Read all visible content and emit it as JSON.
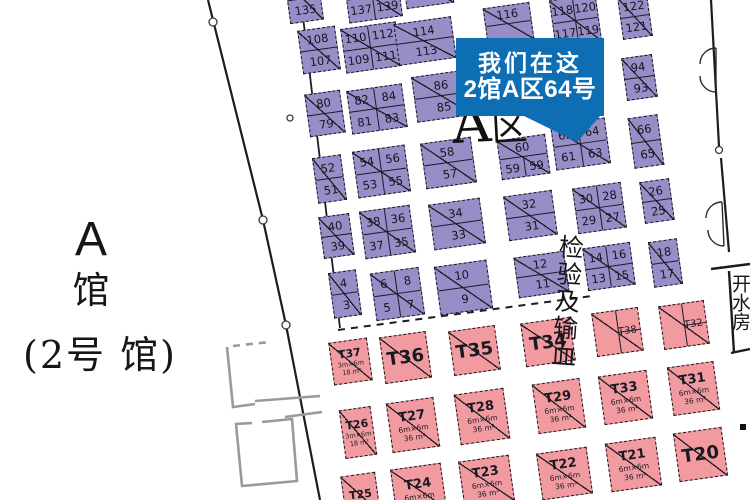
{
  "hall_label": {
    "letter": "A",
    "hall_char": "馆",
    "sub": "(2号 馆)"
  },
  "zone_label": {
    "a": "A",
    "qu": "区"
  },
  "callout": {
    "line1": "我们在这",
    "line2": "2馆A区64号",
    "color": "#0e6eb4"
  },
  "inspection_label": "检验及输血",
  "water_room_label": "开水房",
  "colors": {
    "booth_purple": "#968fc7",
    "booth_pink": "#f19ba1",
    "callout_blue": "#0e6eb4",
    "wall": "#1c1c24"
  },
  "purple_booths": [
    {
      "id": "135",
      "x": 287,
      "y": -24,
      "w": 34,
      "h": 46,
      "cols": 1,
      "cells": [
        {
          "t": "",
          "bd": "b"
        },
        {
          "t": "135"
        }
      ]
    },
    {
      "id": "137-139",
      "x": 346,
      "y": -26,
      "w": 54,
      "h": 46,
      "cols": 2,
      "cells": [
        {
          "t": "",
          "bd": "rb"
        },
        {
          "t": "",
          "bd": "b"
        },
        {
          "t": "137",
          "bd": "r"
        },
        {
          "t": "139"
        }
      ]
    },
    {
      "id": "top-sliver",
      "x": 404,
      "y": -30,
      "w": 48,
      "h": 36,
      "cols": 1,
      "cells": [
        {
          "t": "",
          "bd": "b"
        },
        {
          "t": ""
        }
      ]
    },
    {
      "id": "108-107",
      "x": 300,
      "y": 28,
      "w": 38,
      "h": 44,
      "cols": 1,
      "cells": [
        {
          "t": "108",
          "bd": "b"
        },
        {
          "t": "107"
        }
      ]
    },
    {
      "id": "110-112-109-111",
      "x": 343,
      "y": 25,
      "w": 56,
      "h": 45,
      "cols": 2,
      "cells": [
        {
          "t": "110",
          "bd": "rb"
        },
        {
          "t": "112",
          "bd": "b"
        },
        {
          "t": "109",
          "bd": "r"
        },
        {
          "t": "111"
        }
      ]
    },
    {
      "id": "114-113",
      "x": 396,
      "y": 20,
      "w": 58,
      "h": 42,
      "cols": 1,
      "cells": [
        {
          "t": "114",
          "bd": "b"
        },
        {
          "t": "113"
        }
      ]
    },
    {
      "id": "116",
      "x": 485,
      "y": 5,
      "w": 47,
      "h": 37,
      "cols": 1,
      "cells": [
        {
          "t": "116",
          "bd": "b"
        },
        {
          "t": ""
        }
      ]
    },
    {
      "id": "118-120-117-119",
      "x": 552,
      "y": -3,
      "w": 47,
      "h": 47,
      "cols": 2,
      "cells": [
        {
          "t": "118",
          "bd": "rb"
        },
        {
          "t": "120",
          "bd": "b"
        },
        {
          "t": "117",
          "bd": "r"
        },
        {
          "t": "119"
        }
      ]
    },
    {
      "id": "122-121",
      "x": 620,
      "y": -5,
      "w": 30,
      "h": 43,
      "cols": 1,
      "cells": [
        {
          "t": "122",
          "bd": "b"
        },
        {
          "t": "121"
        }
      ]
    },
    {
      "id": "94-93",
      "x": 624,
      "y": 56,
      "w": 31,
      "h": 43,
      "cols": 1,
      "cells": [
        {
          "t": "94",
          "bd": "b"
        },
        {
          "t": "93"
        }
      ]
    },
    {
      "id": "80-79",
      "x": 307,
      "y": 92,
      "w": 36,
      "h": 43,
      "cols": 1,
      "cells": [
        {
          "t": "80",
          "bd": "b"
        },
        {
          "t": "79"
        }
      ]
    },
    {
      "id": "82-84-81-83",
      "x": 349,
      "y": 87,
      "w": 56,
      "h": 44,
      "cols": 2,
      "cells": [
        {
          "t": "82",
          "bd": "rb"
        },
        {
          "t": "84",
          "bd": "b"
        },
        {
          "t": "81",
          "bd": "r"
        },
        {
          "t": "83"
        }
      ]
    },
    {
      "id": "86-85",
      "x": 414,
      "y": 73,
      "w": 57,
      "h": 46,
      "cols": 1,
      "cells": [
        {
          "t": "86",
          "bd": "b"
        },
        {
          "t": "85"
        }
      ]
    },
    {
      "id": "60-59",
      "x": 499,
      "y": 137,
      "w": 49,
      "h": 40,
      "cols": 2,
      "cells": [
        {
          "t": "60",
          "bd": "b",
          "span": 2
        },
        {
          "t": "59",
          "bd": "r"
        },
        {
          "t": "59"
        }
      ]
    },
    {
      "id": "62-64-61-63",
      "x": 553,
      "y": 121,
      "w": 55,
      "h": 46,
      "cols": 2,
      "cells": [
        {
          "t": "62",
          "bd": "rb"
        },
        {
          "t": "64",
          "bd": "b"
        },
        {
          "t": "61",
          "bd": "r"
        },
        {
          "t": "63"
        }
      ]
    },
    {
      "id": "66-65",
      "x": 631,
      "y": 116,
      "w": 30,
      "h": 51,
      "cols": 1,
      "cells": [
        {
          "t": "66",
          "bd": "b"
        },
        {
          "t": "65"
        }
      ]
    },
    {
      "id": "58-57",
      "x": 423,
      "y": 140,
      "w": 51,
      "h": 46,
      "cols": 1,
      "cells": [
        {
          "t": "58",
          "bd": "b"
        },
        {
          "t": "57"
        }
      ]
    },
    {
      "id": "54-56-53-55",
      "x": 355,
      "y": 148,
      "w": 53,
      "h": 47,
      "cols": 2,
      "cells": [
        {
          "t": "54",
          "bd": "rb"
        },
        {
          "t": "56",
          "bd": "b"
        },
        {
          "t": "53",
          "bd": "r"
        },
        {
          "t": "55"
        }
      ]
    },
    {
      "id": "52-51",
      "x": 315,
      "y": 156,
      "w": 29,
      "h": 46,
      "cols": 1,
      "cells": [
        {
          "t": "52",
          "bd": "b"
        },
        {
          "t": "51"
        }
      ]
    },
    {
      "id": "32-31",
      "x": 506,
      "y": 193,
      "w": 49,
      "h": 45,
      "cols": 1,
      "cells": [
        {
          "t": "32",
          "bd": "b"
        },
        {
          "t": "31"
        }
      ]
    },
    {
      "id": "30-28-29-27",
      "x": 575,
      "y": 185,
      "w": 49,
      "h": 46,
      "cols": 2,
      "cells": [
        {
          "t": "30",
          "bd": "rb"
        },
        {
          "t": "28",
          "bd": "b"
        },
        {
          "t": "29",
          "bd": "r"
        },
        {
          "t": "27"
        }
      ]
    },
    {
      "id": "26-25",
      "x": 642,
      "y": 180,
      "w": 30,
      "h": 42,
      "cols": 1,
      "cells": [
        {
          "t": "26",
          "bd": "b"
        },
        {
          "t": "25"
        }
      ]
    },
    {
      "id": "34-33",
      "x": 431,
      "y": 201,
      "w": 52,
      "h": 46,
      "cols": 1,
      "cells": [
        {
          "t": "34",
          "bd": "b"
        },
        {
          "t": "33"
        }
      ]
    },
    {
      "id": "38-36-37-35",
      "x": 362,
      "y": 208,
      "w": 51,
      "h": 48,
      "cols": 2,
      "cells": [
        {
          "t": "38",
          "bd": "rb"
        },
        {
          "t": "36",
          "bd": "b"
        },
        {
          "t": "37",
          "bd": "r"
        },
        {
          "t": "35"
        }
      ]
    },
    {
      "id": "40-39",
      "x": 321,
      "y": 215,
      "w": 31,
      "h": 42,
      "cols": 1,
      "cells": [
        {
          "t": "40",
          "bd": "b"
        },
        {
          "t": "39"
        }
      ]
    },
    {
      "id": "12-11",
      "x": 516,
      "y": 254,
      "w": 51,
      "h": 41,
      "cols": 1,
      "cells": [
        {
          "t": "12",
          "bd": "b"
        },
        {
          "t": "11"
        }
      ]
    },
    {
      "id": "14-16-13-15",
      "x": 585,
      "y": 245,
      "w": 48,
      "h": 43,
      "cols": 2,
      "cells": [
        {
          "t": "14",
          "bd": "rb"
        },
        {
          "t": "16",
          "bd": "b"
        },
        {
          "t": "13",
          "bd": "r"
        },
        {
          "t": "15"
        }
      ]
    },
    {
      "id": "18-17",
      "x": 651,
      "y": 240,
      "w": 29,
      "h": 46,
      "cols": 1,
      "cells": [
        {
          "t": "18",
          "bd": "b"
        },
        {
          "t": "17"
        }
      ]
    },
    {
      "id": "10-9",
      "x": 437,
      "y": 263,
      "w": 53,
      "h": 49,
      "cols": 1,
      "cells": [
        {
          "t": "10",
          "bd": "b"
        },
        {
          "t": "9"
        }
      ]
    },
    {
      "id": "6-8-5-7",
      "x": 373,
      "y": 270,
      "w": 49,
      "h": 48,
      "cols": 2,
      "cells": [
        {
          "t": "6",
          "bd": "rb"
        },
        {
          "t": "8",
          "bd": "b"
        },
        {
          "t": "5",
          "bd": "r"
        },
        {
          "t": "7"
        }
      ]
    },
    {
      "id": "4-3",
      "x": 331,
      "y": 271,
      "w": 28,
      "h": 46,
      "cols": 1,
      "cells": [
        {
          "t": "4",
          "bd": "b"
        },
        {
          "t": "3"
        }
      ]
    }
  ],
  "pink_booths": [
    {
      "id": "T37",
      "x": 331,
      "y": 340,
      "w": 39,
      "h": 43,
      "size": "xs",
      "title": "T37",
      "sub1": "3m×6m",
      "sub2": "18 m²"
    },
    {
      "id": "T36",
      "x": 382,
      "y": 334,
      "w": 47,
      "h": 47,
      "size": "lg",
      "title": "T36"
    },
    {
      "id": "T35",
      "x": 451,
      "y": 328,
      "w": 47,
      "h": 45,
      "size": "lg",
      "title": "T35"
    },
    {
      "id": "T34",
      "x": 523,
      "y": 320,
      "w": 50,
      "h": 44,
      "size": "lg",
      "title": "T34"
    },
    {
      "id": "T38",
      "x": 594,
      "y": 310,
      "w": 47,
      "h": 44,
      "size": "md",
      "title": "T38",
      "divided": true
    },
    {
      "id": "T32",
      "x": 661,
      "y": 303,
      "w": 46,
      "h": 44,
      "size": "md",
      "title": "T32",
      "divided": true
    },
    {
      "id": "T26",
      "x": 342,
      "y": 408,
      "w": 32,
      "h": 49,
      "size": "xs",
      "title": "T26",
      "sub1": "3m×6m",
      "sub2": "18 m²"
    },
    {
      "id": "T27",
      "x": 389,
      "y": 400,
      "w": 48,
      "h": 50,
      "size": "md",
      "title": "T27",
      "sub1": "6m×6m",
      "sub2": "36 m²"
    },
    {
      "id": "T28",
      "x": 457,
      "y": 391,
      "w": 50,
      "h": 51,
      "size": "md",
      "title": "T28",
      "sub1": "6m×6m",
      "sub2": "36 m²"
    },
    {
      "id": "T29",
      "x": 535,
      "y": 381,
      "w": 48,
      "h": 50,
      "size": "md",
      "title": "T29",
      "sub1": "6m×6m",
      "sub2": "36 m²"
    },
    {
      "id": "T33",
      "x": 601,
      "y": 373,
      "w": 49,
      "h": 49,
      "size": "md",
      "title": "T33",
      "sub1": "6m×6m",
      "sub2": "36 m²"
    },
    {
      "id": "T31",
      "x": 670,
      "y": 364,
      "w": 47,
      "h": 49,
      "size": "md",
      "title": "T31",
      "sub1": "6m×6m",
      "sub2": "36 m²"
    },
    {
      "id": "T25",
      "x": 343,
      "y": 474,
      "w": 35,
      "h": 41,
      "size": "xs",
      "title": "T25"
    },
    {
      "id": "T24",
      "x": 393,
      "y": 466,
      "w": 51,
      "h": 46,
      "size": "md",
      "title": "T24",
      "sub1": "6m×6m"
    },
    {
      "id": "T23",
      "x": 461,
      "y": 458,
      "w": 51,
      "h": 46,
      "size": "md",
      "title": "T23",
      "sub1": "6m×6m",
      "sub2": "36 m²"
    },
    {
      "id": "T22",
      "x": 539,
      "y": 450,
      "w": 51,
      "h": 47,
      "size": "md",
      "title": "T22",
      "sub1": "6m×6m",
      "sub2": "36 m²"
    },
    {
      "id": "T21",
      "x": 608,
      "y": 440,
      "w": 51,
      "h": 49,
      "size": "md",
      "title": "T21",
      "sub1": "6m×6m",
      "sub2": "36 m²"
    },
    {
      "id": "T20",
      "x": 676,
      "y": 430,
      "w": 49,
      "h": 49,
      "size": "lg",
      "title": "T20"
    }
  ]
}
